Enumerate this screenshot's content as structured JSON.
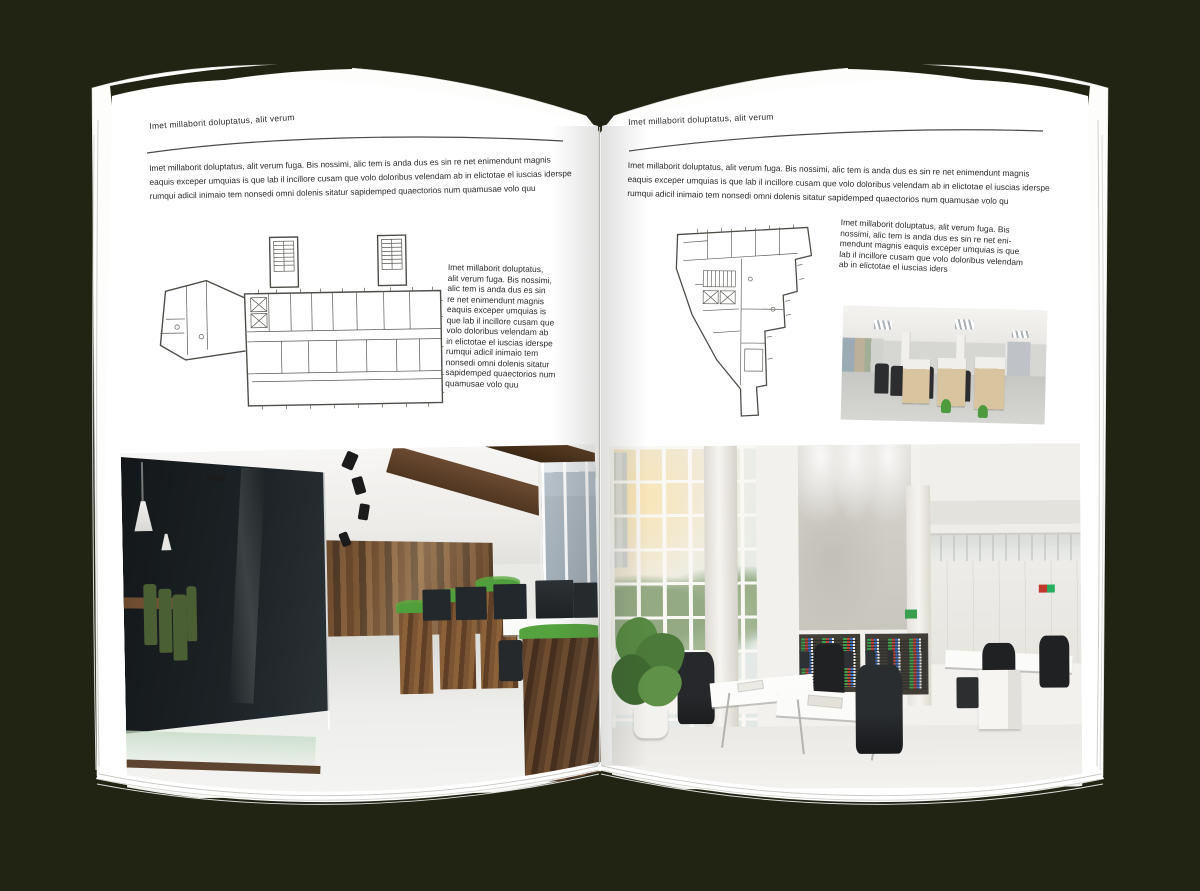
{
  "scene": {
    "mockup_type": "open-magazine-spread",
    "background_color": "#222413",
    "paper_color": "#ffffff"
  },
  "left_page": {
    "header": "Imet millaborit doluptatus, alit verum",
    "intro_lines": [
      "Imet millaborit doluptatus, alit verum fuga. Bis nossimi, alic tem is anda dus es sin re net enimendunt magnis",
      "eaquis exceper umquias is que lab il incillore cusam que volo doloribus velendam ab in elictotae el iuscias iderspe",
      "rumqui adicil inimaio tem nonsedi omni dolenis sitatur sapidemped quaectorios num quamusae volo quu"
    ],
    "side_text_lines": [
      "Imet millaborit doluptatus,",
      "alit verum fuga. Bis nossimi,",
      "alic tem is anda dus es sin",
      "re net enimendunt magnis",
      "eaquis exceper umquias is",
      "que lab il incillore cusam que",
      "volo doloribus velendam ab",
      "in elictotae el iuscias iderspe",
      "rumqui adicil inimaio tem",
      "nonsedi omni dolenis sitatur",
      "sapidemped quaectorios num",
      "quamusae volo quu"
    ],
    "figure": "architectural-floor-plan",
    "photo": "dark-wood-open-space-office-photo"
  },
  "right_page": {
    "header": "Imet millaborit doluptatus, alit verum",
    "intro_lines": [
      "Imet millaborit doluptatus, alit verum fuga. Bis nossimi, alic tem is anda dus es sin re net enimendunt magnis",
      "eaquis exceper umquias is que lab il incillore cusam que volo doloribus velendam ab in elictotae el iuscias iderspe",
      "rumqui adicil inimaio tem nonsedi omni dolenis sitatur sapidemped quaectorios num quamusae volo qu"
    ],
    "side_text_lines": [
      "Imet millaborit doluptatus, alit verum fuga. Bis",
      "nossimi, alic tem is anda dus es sin re net eni-",
      "mendunt magnis eaquis exceper umquias is que",
      "lab il incillore cusam que volo doloribus velendam",
      "ab in elictotae el iuscias iders"
    ],
    "figure": "architectural-floor-plan-irregular",
    "photo_small": "office-cubicles-photo",
    "photo": "bright-atrium-office-photo"
  },
  "colors": {
    "background": "#222413",
    "paper": "#ffffff",
    "text": "#2b2b2b",
    "header_rule": "#4a4a4a",
    "plan_line": "#4f4d48",
    "spine_shadow": "rgba(60,60,55,0.18)"
  }
}
